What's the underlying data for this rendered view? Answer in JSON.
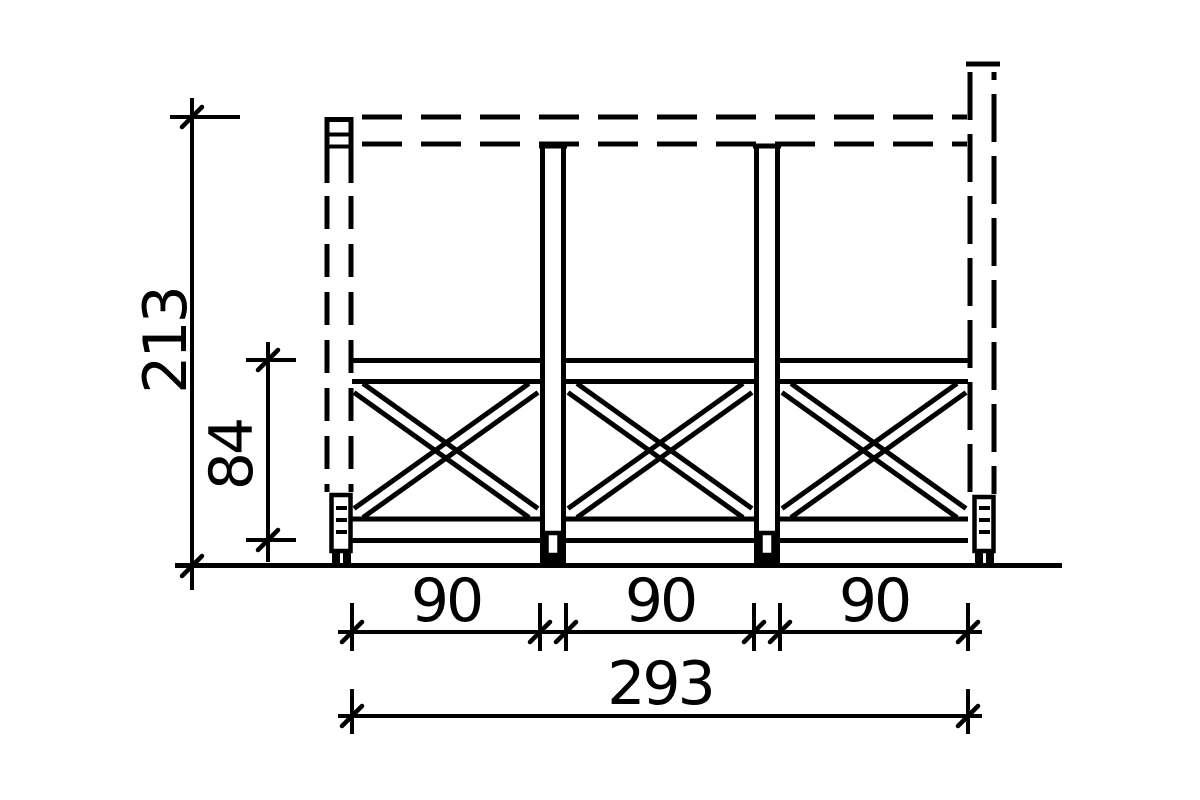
{
  "drawing": {
    "kind": "technical-elevation-railing-with-cross-braces",
    "colors": {
      "line": "#000000",
      "background": "#ffffff"
    },
    "dimensions": {
      "total_height": {
        "label": "213"
      },
      "railing_height": {
        "label": "84"
      },
      "bay_widths": [
        {
          "label": "90"
        },
        {
          "label": "90"
        },
        {
          "label": "90"
        }
      ],
      "total_width": {
        "label": "293"
      }
    }
  }
}
